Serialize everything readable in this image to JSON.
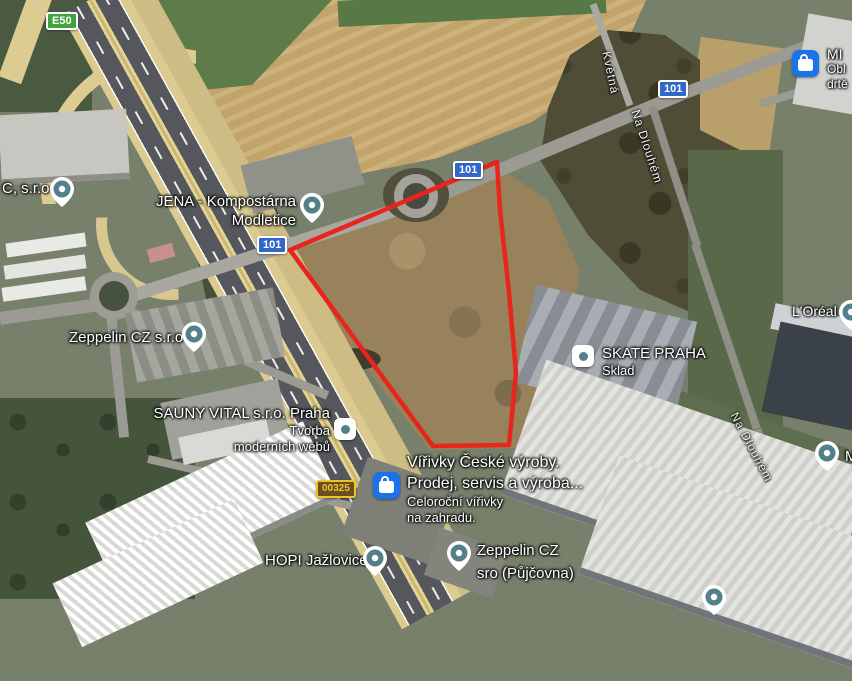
{
  "badges": {
    "e50": "E50",
    "r101": "101",
    "r00325": "00325"
  },
  "streets": {
    "kvetna": "Květná",
    "na_dlouhem": "Na Dlouhém"
  },
  "pois": {
    "c_sro": {
      "line1": "C, s.r.o"
    },
    "jena": {
      "line1": "JENA - Kompostárna",
      "line2": "Modletice"
    },
    "zeppelin_cz": {
      "line1": "Zeppelin CZ s.r.o"
    },
    "sauny_vital": {
      "line1": "SAUNY VITAL s.r.o. Praha",
      "line2": "Tvorba",
      "line3": "moderních webů"
    },
    "virivky": {
      "line1": "Vířivky České výroby.",
      "line2": "Prodej, servis a výroba...",
      "line3": "Celoroční vířivky",
      "line4": "na zahradu."
    },
    "skate_praha": {
      "line1": "SKATE PRAHA",
      "line2": "Sklad"
    },
    "loreal": {
      "line1": "L'Oréal"
    },
    "mi_shop": {
      "line1": "MI",
      "line2": "Obl",
      "line3": "drtě"
    },
    "hopi": {
      "line1": "HOPI Jažlovice"
    },
    "zeppelin_pujcovna": {
      "line1": "Zeppelin CZ",
      "line2": "sro (Půjčovna)"
    },
    "m_partial": {
      "line1": "M"
    }
  },
  "colors": {
    "boundary": "#e7251c",
    "pin_teal": "#54808a",
    "shop_blue": "#1a73e8",
    "badge_blue": "#3067c8",
    "badge_green": "#3fa33f",
    "badge_gold_bg": "#6b4e20",
    "badge_gold": "#eec32a"
  }
}
